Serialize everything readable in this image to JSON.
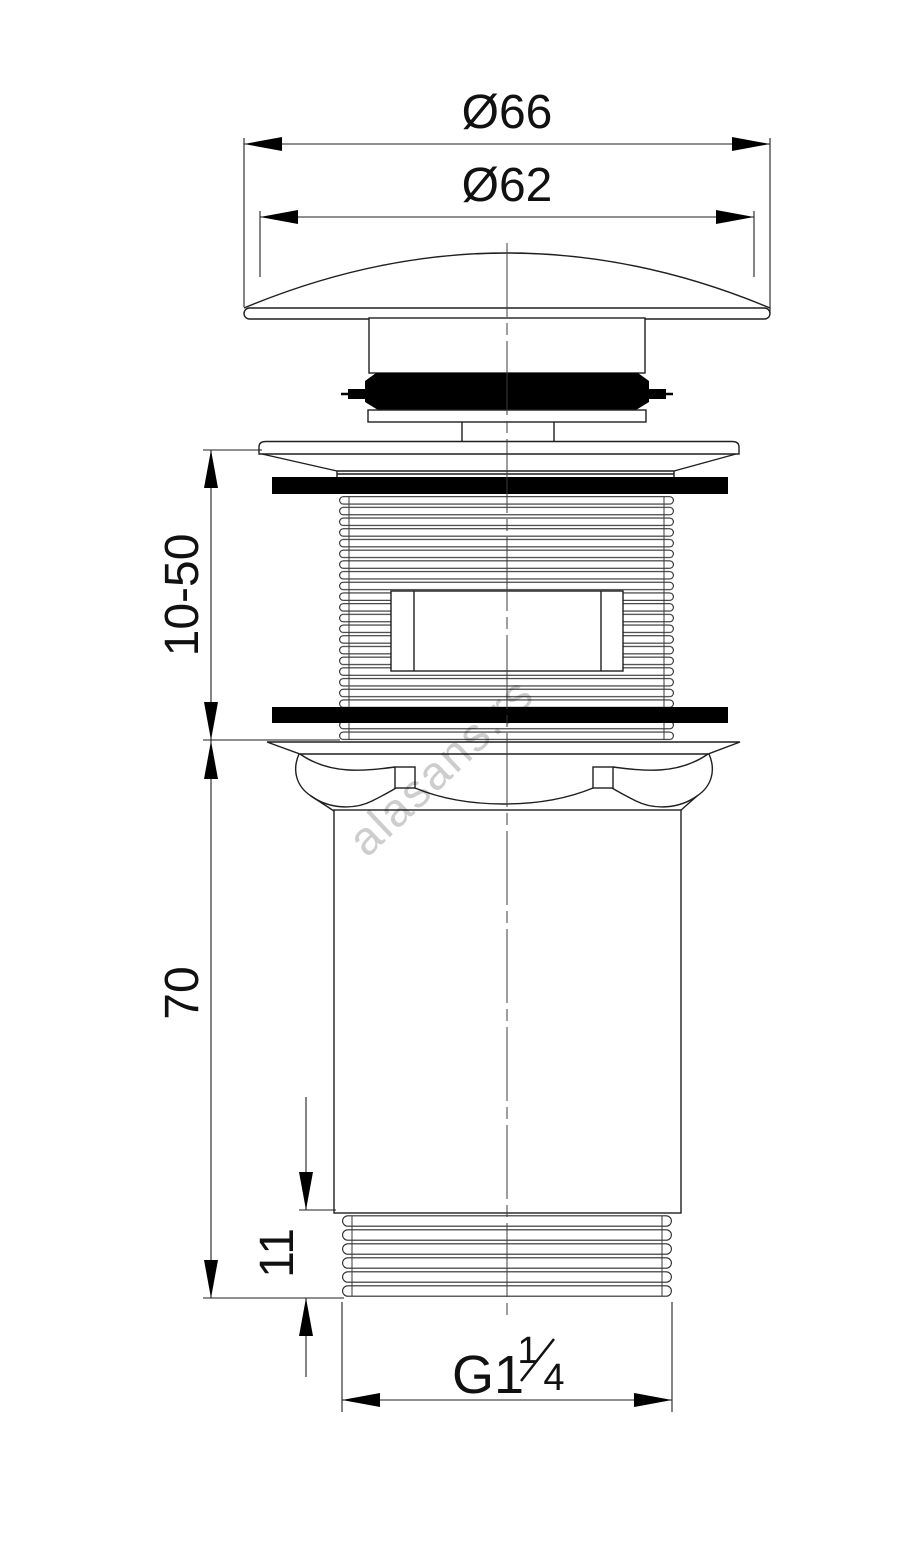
{
  "drawing": {
    "dimensions": {
      "cap_outer_diameter": "Ø66",
      "cap_inner_diameter": "Ø62",
      "adjustable_height_range": "10-50",
      "body_length": "70",
      "bottom_thread_length": "11"
    },
    "thread_spec": {
      "prefix": "G1",
      "numerator": "1",
      "denominator": "4"
    },
    "watermark": "alasans.rs",
    "colors": {
      "line": "#1f1f1f",
      "solid_fill": "#000000",
      "watermark": "#c8c8c8",
      "background": "#ffffff"
    }
  }
}
